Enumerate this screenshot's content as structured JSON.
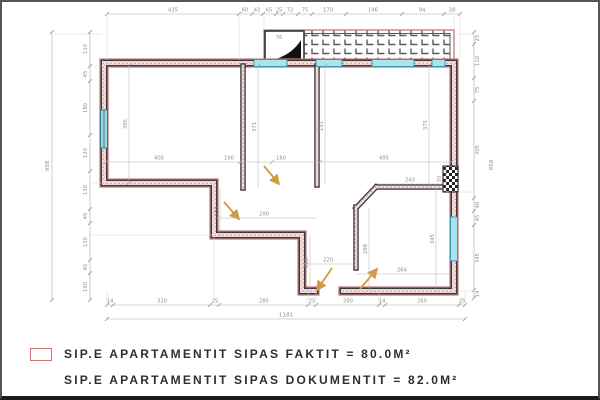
{
  "title": "apartment-floor-plan",
  "legend": {
    "items": [
      {
        "has_swatch": true,
        "text": "SIP.E APARTAMENTIT SIPAS FAKTIT = 80.0M²"
      },
      {
        "has_swatch": false,
        "text": "SIP.E APARTAMENTIT SIPAS DOKUMENTIT = 82.0M²"
      }
    ]
  },
  "colors": {
    "wall_dark": "#3a3a3a",
    "wall_fill_pink": "#f3dcdc",
    "red_outline": "#c98080",
    "window_cyan": "#a8e4ee",
    "window_teal": "#9fd8e0",
    "dim_line": "#aaaaaa",
    "dim_text": "#8f8f8f",
    "door_arrow": "#cf9a40",
    "legend_swatch_border": "#cc7777"
  },
  "dims": {
    "top": [
      "435",
      "60",
      "43",
      "65",
      "25",
      "72",
      "75",
      "170",
      "146",
      "94",
      "28"
    ],
    "left_inner": [
      "110",
      "45",
      "180",
      "120",
      "130",
      "45",
      "130",
      "45",
      "190"
    ],
    "left_total": "958",
    "right_inner": [
      "25",
      "110",
      "75",
      "305",
      "40",
      "45",
      "345",
      "14"
    ],
    "right_total": "858",
    "bottom": [
      "14",
      "310",
      "25",
      "285",
      "25",
      "200",
      "14",
      "260",
      "25"
    ],
    "bottom_total": "1181",
    "interior": {
      "living_w": "405",
      "living_h": "365",
      "hall_w": "100",
      "hall_door": "160",
      "hall_h": "371",
      "big_w": "495",
      "big_h_left": "191",
      "big_h_right": "375",
      "shaft": "70",
      "br_top": "243",
      "corr_w": "200",
      "corr_h": "155",
      "mid_w": "220",
      "mid_h": "213",
      "br_h_mid": "298",
      "br_h_right": "345",
      "br_w": "264",
      "balcony_cell": "76"
    }
  }
}
